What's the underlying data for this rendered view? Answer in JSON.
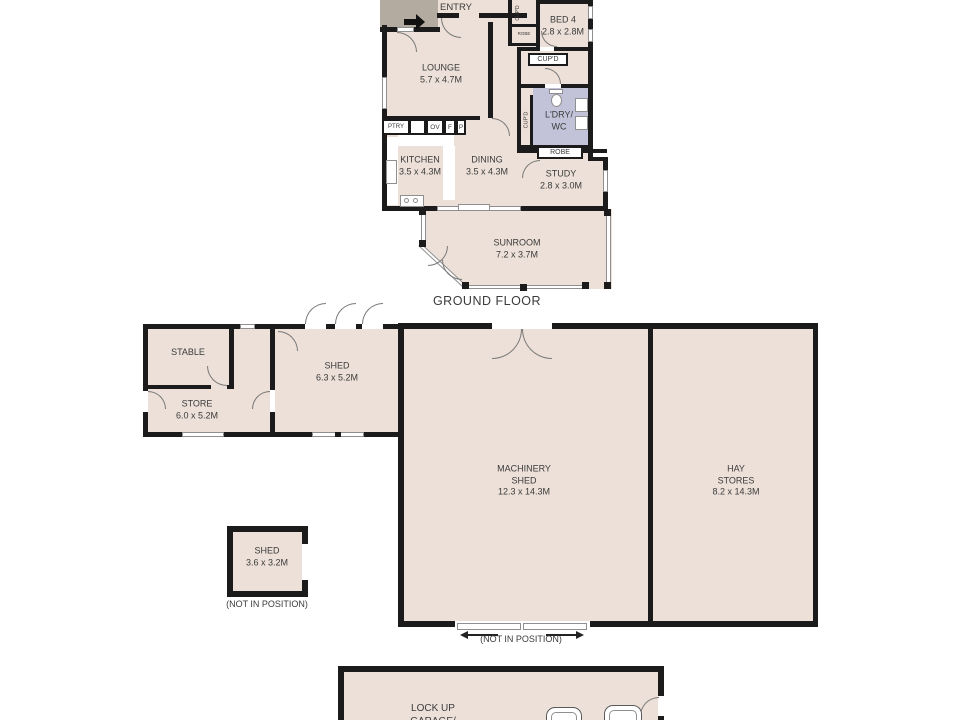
{
  "floor_label": "GROUND FLOOR",
  "house": {
    "entry": {
      "label": "ENTRY"
    },
    "bed4": {
      "name": "BED 4",
      "dims": "2.8 x 2.8M"
    },
    "lounge": {
      "name": "LOUNGE",
      "dims": "5.7 x 4.7M"
    },
    "closet_cupd": {
      "label": "CUP'D"
    },
    "closet_robe": {
      "label": "ROBE"
    },
    "cupd_room": {
      "label": "CUP'D"
    },
    "laundry": {
      "line1": "L'DRY/",
      "line2": "WC"
    },
    "laundry_cupd": {
      "label": "CUP'D"
    },
    "robe": {
      "label": "ROBE"
    },
    "study": {
      "name": "STUDY",
      "dims": "2.8 x 3.0M"
    },
    "kitchen": {
      "name": "KITCHEN",
      "dims": "3.5 x 4.3M"
    },
    "dining": {
      "name": "DINING",
      "dims": "3.5 x 4.3M"
    },
    "sunroom": {
      "name": "SUNROOM",
      "dims": "7.2 x 3.7M"
    },
    "cabinets": {
      "ptry": "PTRY",
      "ov": "OV",
      "f": "F",
      "p": "P"
    }
  },
  "outbuildings": {
    "stable": {
      "name": "STABLE"
    },
    "store": {
      "name": "STORE",
      "dims": "6.0 x 5.2M"
    },
    "shed_large": {
      "name": "SHED",
      "dims": "6.3 x 5.2M"
    },
    "machinery_shed": {
      "line1": "MACHINERY",
      "line2": "SHED",
      "dims": "12.3 x 14.3M"
    },
    "hay_stores": {
      "line1": "HAY",
      "line2": "STORES",
      "dims": "8.2 x 14.3M"
    },
    "shed_small": {
      "name": "SHED",
      "dims": "3.6 x 3.2M"
    },
    "garage": {
      "line1": "LOCK UP",
      "line2": "GARAGE/"
    }
  },
  "notes": {
    "not_in_position_shed": "(NOT IN POSITION)",
    "not_in_position_machinery": "(NOT IN POSITION)"
  },
  "colors": {
    "room_fill": "#ece0d8",
    "laundry_fill": "#c2c3d9",
    "porch_fill": "#b3aba0",
    "wall": "#1b1b1b",
    "text": "#3b3b3b"
  }
}
